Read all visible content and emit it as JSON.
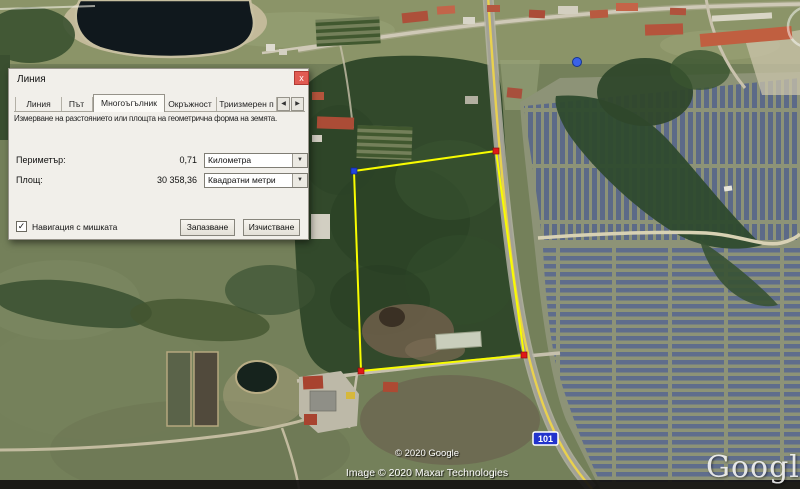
{
  "window": {
    "title": "Линия"
  },
  "icons": {
    "close": "x",
    "dropdown": "▼",
    "scroll_left": "◀",
    "scroll_right": "▶",
    "check": "✓"
  },
  "tabs": {
    "items": [
      {
        "label": "Линия"
      },
      {
        "label": "Път"
      },
      {
        "label": "Многоъгълник"
      },
      {
        "label": "Окръжност"
      },
      {
        "label": "Триизмерен п"
      }
    ],
    "active": "Многоъгълник"
  },
  "content": {
    "description": "Измерване на разстоянието или площта на геометрична форма на земята.",
    "perimeter_label": "Периметър:",
    "perimeter_value": "0,71",
    "perimeter_unit": "Километра",
    "area_label": "Площ:",
    "area_value": "30 358,36",
    "area_unit": "Квадратни метри",
    "mouse_nav_label": "Навигация с мишката",
    "mouse_nav_checked": true,
    "save_button": "Запазване",
    "clear_button": "Изчистване"
  },
  "map": {
    "road_shield": "101",
    "copyright_google": "© 2020 Google",
    "copyright_imagery": "Image © 2020 Maxar Technologies",
    "watermark": "Google e"
  },
  "measurement": {
    "perimeter_km": "0,71",
    "area_sq_m": "30 358,36"
  },
  "colors": {
    "polygon_yellow": "#f8fc00",
    "road_yellow": "#e9d14e",
    "shield_blue": "#2233cc",
    "vertex_red": "#e01818",
    "vertex_blue": "#2244dd"
  }
}
